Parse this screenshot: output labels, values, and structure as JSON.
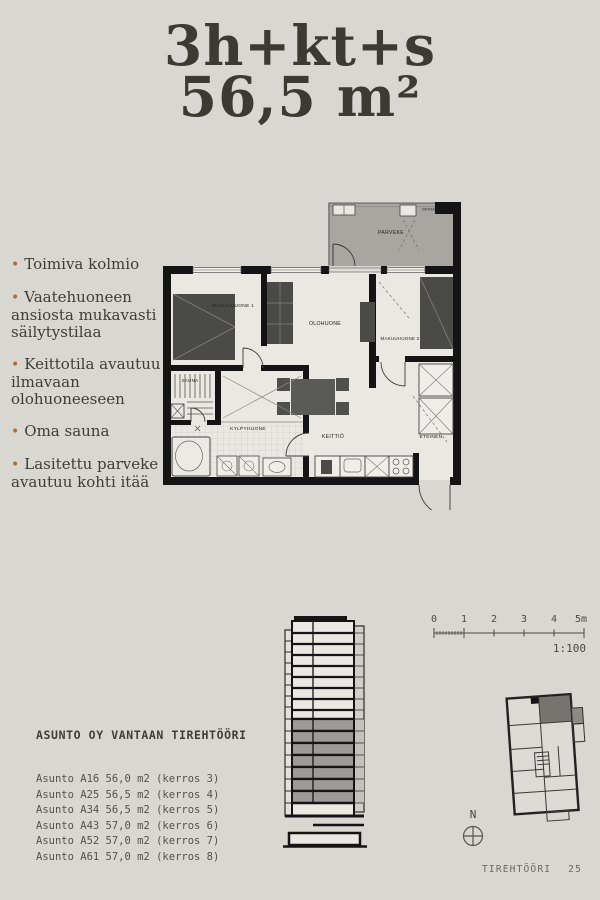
{
  "title": {
    "line1": "3h+kt+s",
    "line2": "56,5 m²"
  },
  "features": [
    "Toimiva kolmio",
    "Vaatehuoneen ansiosta mukavasti säilytystilaa",
    "Keittotila avautuu ilmavaan olohuoneeseen",
    "Oma sauna",
    "Lasitettu parveke avautuu kohti itää"
  ],
  "plan": {
    "labels": {
      "parveke": "PARVEKE",
      "makuuhuone1": "MAKUUHUONE 1",
      "olohuone": "OLOHUONE",
      "makuuhuone2": "MAKUUHUONE 2",
      "sauna": "SAUNA",
      "kylpyhuone": "KYLPYHUONE",
      "keittio": "KEITTIÖ",
      "eteinen": "ETEINEN",
      "glazing_note": "KIINTEÄ LASITUS"
    }
  },
  "scalebar": {
    "ticks": [
      "0",
      "1",
      "2",
      "3",
      "4",
      "5m"
    ],
    "ratio": "1:100"
  },
  "project": {
    "name": "ASUNTO OY VANTAAN TIREHTÖÖRI",
    "apartments": [
      "Asunto A16 56,0 m2 (kerros 3)",
      "Asunto A25 56,5 m2 (kerros 4)",
      "Asunto A34 56,5 m2 (kerros 5)",
      "Asunto A43 57,0 m2 (kerros 6)",
      "Asunto A52 57,0 m2 (kerros 7)",
      "Asunto A61 57,0 m2 (kerros 8)"
    ]
  },
  "siteplan": {
    "north_label": "N"
  },
  "footer": {
    "project": "TIREHTÖÖRI",
    "page": "25"
  },
  "colors": {
    "background": "#d8d7d1",
    "accent_bullet": "#b26a34",
    "wall": "#141414",
    "floor": "#e9e8e2",
    "balcony": "#a7a6a1",
    "furniture": "#4a4a47",
    "highlight_unit": "#75746e"
  }
}
